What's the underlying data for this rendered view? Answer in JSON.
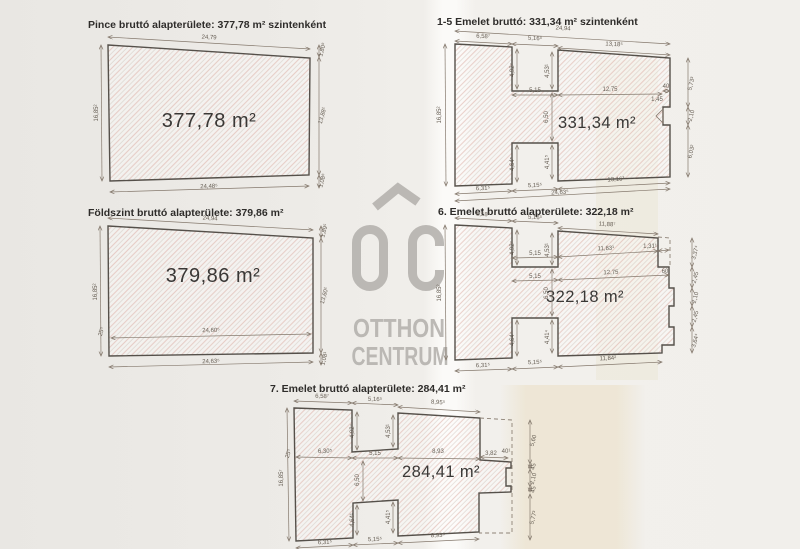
{
  "watermark": {
    "line1": "OTTHON",
    "line2": "CENTRUM"
  },
  "plans": {
    "pince": {
      "title": "Pince bruttó alapterülete: 377,78 m² szintenként",
      "area": "377,78 m²",
      "dims": {
        "top": "24,79",
        "bottom": "24,48⁵",
        "left": "16,85²",
        "right_top": "1,80⁸",
        "right_mid": "13,88¹",
        "right_bot": "1,08⁶"
      }
    },
    "fsz": {
      "title": "Földszint bruttó alapterülete: 379,86 m²",
      "area": "379,86 m²",
      "dims": {
        "top": "24,94",
        "inner": "24,60⁵",
        "bottom": "24,63⁵",
        "left": "16,85²",
        "left_small": "25⁵",
        "right_top": "1,89⁵",
        "right_mid": "13,60¹",
        "right_bot": "1,08¹"
      }
    },
    "em15": {
      "title": "1-5 Emelet bruttó: 331,34 m² szintenként",
      "area": "331,34 m²",
      "dims": {
        "top_overall": "24,94",
        "top_a": "6,58⁷",
        "top_b": "5,16⁵",
        "top_c": "13,18⁵",
        "notch_l": "4,92⁴",
        "notch_r": "4,53¹",
        "mid_a": "5,15",
        "mid_b": "12,75",
        "mid_c": "40",
        "mid_d": "1,45",
        "left": "16,85²",
        "center": "6,50",
        "bnotch_l": "4,64⁵",
        "bnotch_r": "4,41⁵",
        "bot_a": "6,31⁵",
        "bot_b": "5,15⁵",
        "bot_c": "13,16³",
        "bot_overall": "24,63⁵",
        "right_a": "5,73³",
        "right_b": "2,10",
        "right_c": "6,03²"
      }
    },
    "em6": {
      "title": "6. Emelet bruttó alapterülete: 322,18 m²",
      "area": "322,18 m²",
      "dims": {
        "top_a": "6,58⁴",
        "top_b": "5,16⁵",
        "top_c": "11,88⁷",
        "notch_l": "4,92⁴",
        "notch_r": "4,53¹",
        "rowa_a": "5,15",
        "rowa_b": "11,83¹",
        "rowa_c": "1,31¹",
        "rowb_a": "5,15",
        "rowb_b": "12,75",
        "rowb_c": "60",
        "left": "16,85²",
        "center": "6,50",
        "bnotch_l": "4,64⁴",
        "bnotch_r": "4,41⁴",
        "bot_a": "6,31⁵",
        "bot_b": "5,15⁵",
        "bot_c": "11,84²",
        "right_a": "3,37⁴",
        "right_b": "2,45",
        "right_c": "2,10",
        "right_d": "2,45",
        "right_e": "3,64⁴"
      }
    },
    "em7": {
      "title": "7. Emelet bruttó alapterülete: 284,41 m²",
      "area": "284,41 m²",
      "dims": {
        "top_a": "6,58⁷",
        "top_b": "5,16⁵",
        "top_c": "8,95⁵",
        "notch_l": "4,92⁴",
        "notch_r": "4,53¹",
        "left_small": "25⁵",
        "mid_a": "6,30⁵",
        "mid_b": "5,15",
        "mid_c": "8,93",
        "mid_d": "3,82",
        "mid_e": "40¹",
        "left": "16,85⁷",
        "center": "6,50",
        "bnotch_l": "4,64¹",
        "bnotch_r": "4,41⁵",
        "bot_a": "6,31⁵",
        "bot_b": "5,15⁵",
        "bot_c": "8,93⁵",
        "right_a": "5,60",
        "right_b": "45",
        "right_c": "2,10",
        "right_d": "45",
        "right_e": "5,77³"
      }
    }
  }
}
